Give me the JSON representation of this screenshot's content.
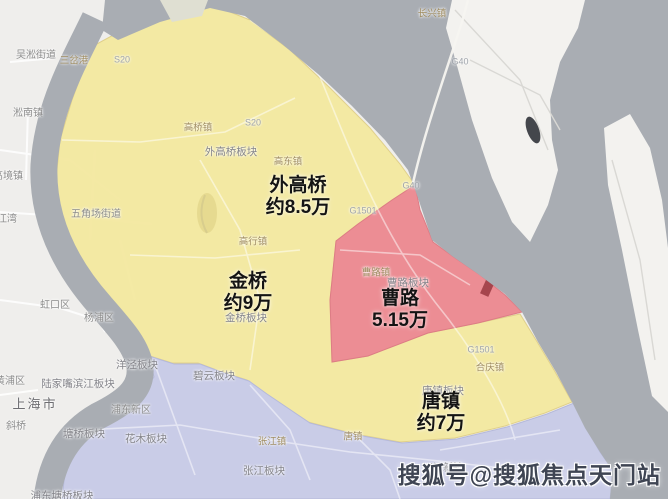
{
  "colors": {
    "land": "#ecebe8",
    "puxi_land": "#efeeec",
    "water": "#a9adb3",
    "island": "#f3f2ef",
    "yellow_zone": "#f4e9a0",
    "red_zone": "#ec8d94",
    "blue_zone": "#c9cce7",
    "dark_red_spot": "#a6454d",
    "big_label_text": "#141414",
    "watermark_text": "#3f4553"
  },
  "regions": [
    {
      "id": "waigaoqiao",
      "name": "外高桥",
      "price": "约8.5万",
      "zone": "yellow",
      "label_x": 298,
      "label_y": 197
    },
    {
      "id": "jinqiao",
      "name": "金桥",
      "price": "约9万",
      "zone": "yellow",
      "label_x": 248,
      "label_y": 293
    },
    {
      "id": "caolu",
      "name": "曹路",
      "price": "5.15万",
      "zone": "red",
      "label_x": 400,
      "label_y": 310
    },
    {
      "id": "tangzhen",
      "name": "唐镇",
      "price": "约7万",
      "zone": "yellow",
      "label_x": 441,
      "label_y": 413
    }
  ],
  "map_labels": [
    {
      "text": "吴淞街道",
      "x": 36,
      "y": 56,
      "kind": "district"
    },
    {
      "text": "三岔港",
      "x": 74,
      "y": 61,
      "kind": "town"
    },
    {
      "text": "S20",
      "x": 122,
      "y": 60,
      "kind": "road"
    },
    {
      "text": "淞南镇",
      "x": 28,
      "y": 114,
      "kind": "district"
    },
    {
      "text": "高桥镇",
      "x": 198,
      "y": 128,
      "kind": "town"
    },
    {
      "text": "S20",
      "x": 253,
      "y": 123,
      "kind": "road"
    },
    {
      "text": "外高桥板块",
      "x": 231,
      "y": 152,
      "kind": "plate"
    },
    {
      "text": "高东镇",
      "x": 288,
      "y": 162,
      "kind": "town"
    },
    {
      "text": "G40",
      "x": 411,
      "y": 186,
      "kind": "road"
    },
    {
      "text": "G1501",
      "x": 363,
      "y": 211,
      "kind": "road"
    },
    {
      "text": "高行镇",
      "x": 253,
      "y": 242,
      "kind": "town"
    },
    {
      "text": "金桥板块",
      "x": 246,
      "y": 318,
      "kind": "plate"
    },
    {
      "text": "曹路镇",
      "x": 376,
      "y": 273,
      "kind": "town"
    },
    {
      "text": "曹路板块",
      "x": 408,
      "y": 283,
      "kind": "plate"
    },
    {
      "text": "G1501",
      "x": 481,
      "y": 350,
      "kind": "road"
    },
    {
      "text": "合庆镇",
      "x": 490,
      "y": 368,
      "kind": "town"
    },
    {
      "text": "唐镇板块",
      "x": 443,
      "y": 391,
      "kind": "plate"
    },
    {
      "text": "唐镇",
      "x": 353,
      "y": 437,
      "kind": "town"
    },
    {
      "text": "川沙新镇",
      "x": 443,
      "y": 469,
      "kind": "district"
    },
    {
      "text": "长兴镇",
      "x": 432,
      "y": 14,
      "kind": "town"
    },
    {
      "text": "G40",
      "x": 460,
      "y": 62,
      "kind": "road"
    },
    {
      "text": "五角场街道",
      "x": 96,
      "y": 215,
      "kind": "district"
    },
    {
      "text": "高境镇",
      "x": 8,
      "y": 177,
      "kind": "district"
    },
    {
      "text": "江湾",
      "x": 7,
      "y": 220,
      "kind": "district"
    },
    {
      "text": "虹口区",
      "x": 55,
      "y": 306,
      "kind": "district"
    },
    {
      "text": "杨浦区",
      "x": 99,
      "y": 319,
      "kind": "district"
    },
    {
      "text": "黄浦区",
      "x": 10,
      "y": 382,
      "kind": "district"
    },
    {
      "text": "上海市",
      "x": 35,
      "y": 404,
      "kind": "city"
    },
    {
      "text": "斜桥",
      "x": 16,
      "y": 427,
      "kind": "district"
    },
    {
      "text": "陆家嘴滨江板块",
      "x": 78,
      "y": 384,
      "kind": "plate"
    },
    {
      "text": "洋泾板块",
      "x": 137,
      "y": 365,
      "kind": "plate"
    },
    {
      "text": "塘桥板块",
      "x": 84,
      "y": 434,
      "kind": "plate"
    },
    {
      "text": "碧云板块",
      "x": 214,
      "y": 376,
      "kind": "plate"
    },
    {
      "text": "花木板块",
      "x": 146,
      "y": 439,
      "kind": "plate"
    },
    {
      "text": "浦东新区",
      "x": 131,
      "y": 411,
      "kind": "district"
    },
    {
      "text": "张江镇",
      "x": 272,
      "y": 442,
      "kind": "town"
    },
    {
      "text": "张江板块",
      "x": 264,
      "y": 471,
      "kind": "plate"
    },
    {
      "text": "浦东塘桥板块",
      "x": 62,
      "y": 496,
      "kind": "plate"
    }
  ],
  "watermark": {
    "text": "搜狐号@搜狐焦点天门站"
  }
}
